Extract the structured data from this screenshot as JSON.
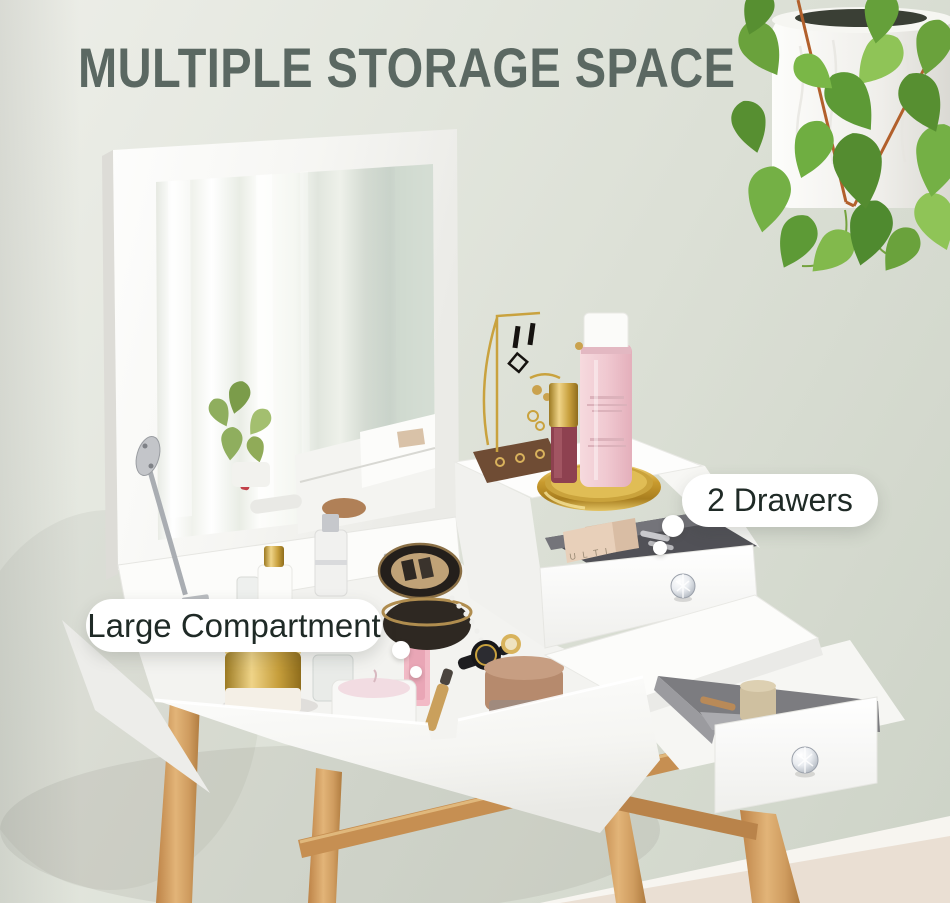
{
  "banner": {
    "title": "MULTIPLE STORAGE SPACE"
  },
  "callouts": {
    "drawers": {
      "label": "2 Drawers"
    },
    "compartment": {
      "label": "Large Compartment"
    }
  },
  "scene": {
    "palette_text": "U L T I",
    "colors": {
      "wall": "#dce0d6",
      "floor": "#eadfd3",
      "baseboard": "#f7f5f0",
      "title_text": "#5b6862",
      "label_text": "#1f2a26",
      "label_bg": "#ffffff",
      "furniture_white": "#fbfbf9",
      "drawer_interior": "#56565a",
      "wood_leg": "#d2a065",
      "gold": "#c9a23e",
      "bronze": "#b68a6d",
      "pink_bottle": "#eec3cb",
      "plant_green": "#6fa53e"
    }
  }
}
